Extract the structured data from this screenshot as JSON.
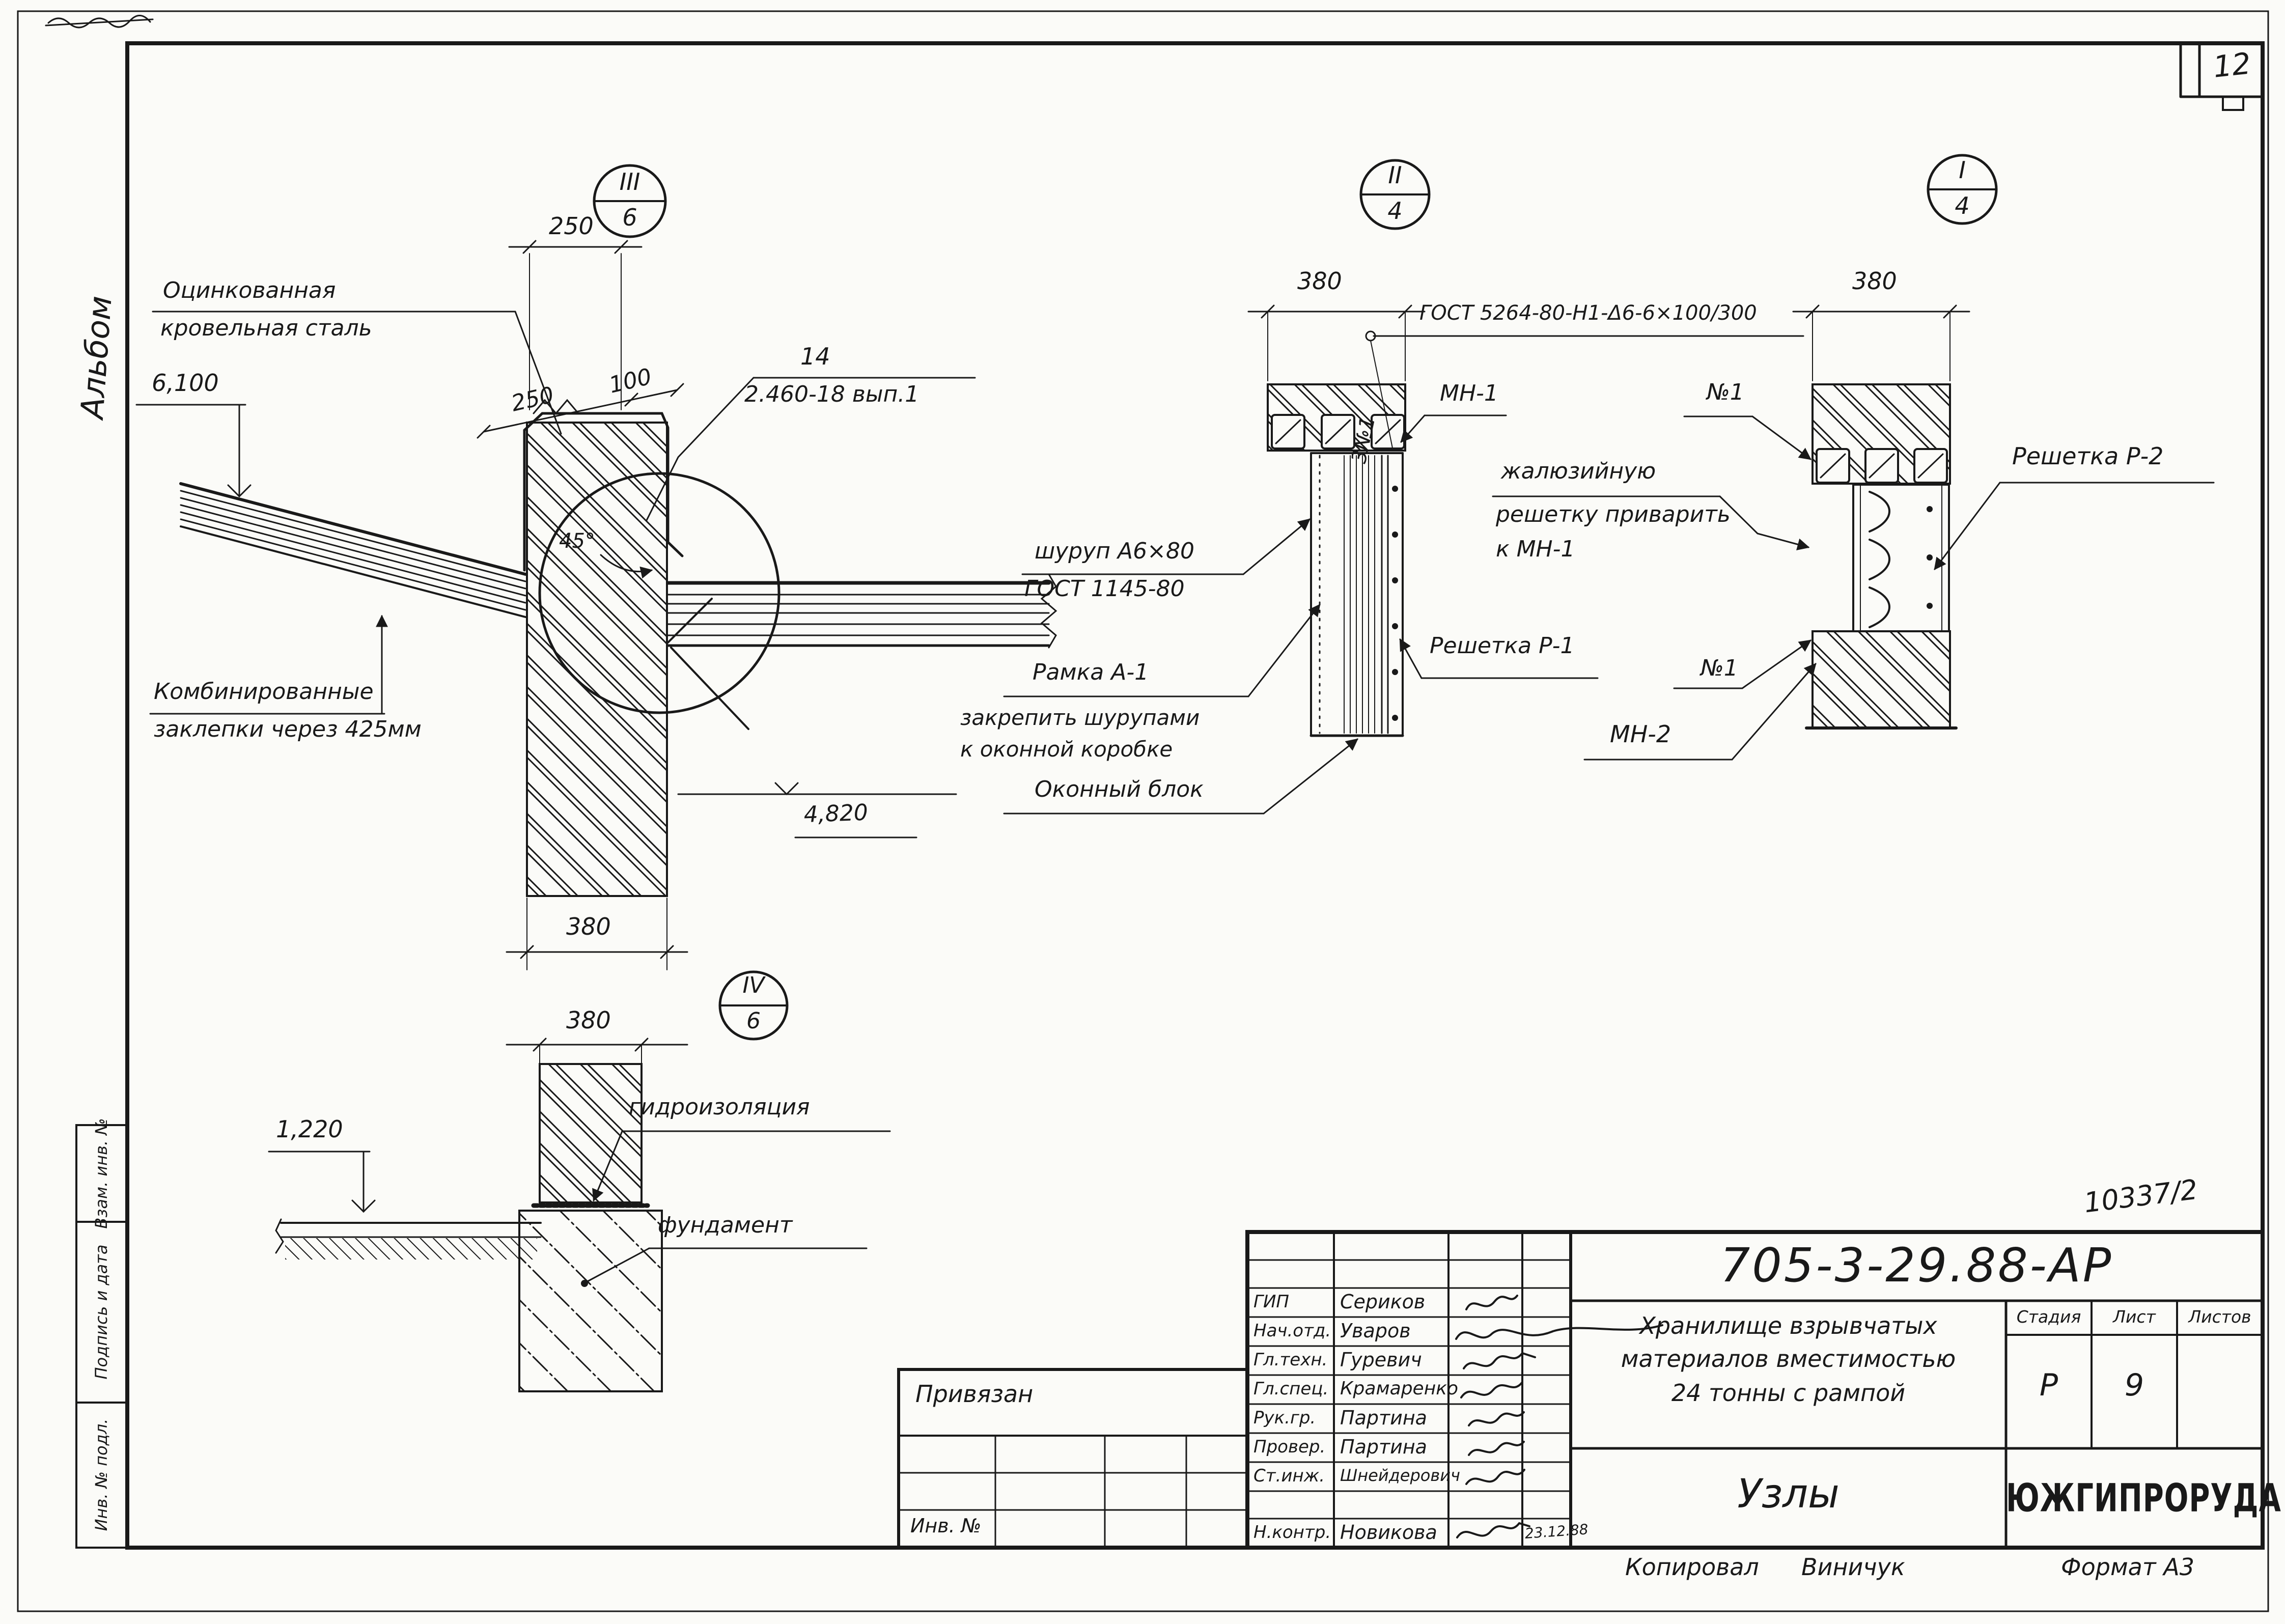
{
  "page": {
    "number": "12",
    "album_label": "Альбом",
    "inv_note": "10337/2",
    "copied_label": "Копировал",
    "copied_name": "Виничук",
    "format_note": "Формат А3",
    "ink_color": "#191919",
    "paper_color": "#fbfbf8"
  },
  "margin_fields": [
    "Взам. инв. №",
    "Подпись и дата",
    "Инв. № подл."
  ],
  "details": {
    "d1": {
      "callout": {
        "num": "III",
        "den": "6"
      },
      "dims": {
        "top": "250",
        "slope_a": "250",
        "slope_b": "100",
        "elev_top": "6,100",
        "elev_mid": "4,820",
        "angle": "45°",
        "width": "380"
      },
      "labels": {
        "steel1": "Оцинкованная",
        "steel2": "кровельная сталь",
        "part_no": "14",
        "part_ref": "2.460-18 вып.1",
        "rivets1": "Комбинированные",
        "rivets2": "заклепки через 425мм"
      }
    },
    "d4": {
      "callout": {
        "num": "IV",
        "den": "6"
      },
      "dims": {
        "width": "380",
        "elev": "1,220"
      },
      "labels": {
        "waterproof": "гидроизоляция",
        "foundation": "фундамент"
      }
    },
    "d2": {
      "callout": {
        "num": "II",
        "den": "4"
      },
      "dims": {
        "width": "380"
      },
      "labels": {
        "gost_weld": "ГОСТ 5264-80-Н1-Δ6-6×100/300",
        "weld_ref": "3№1",
        "mn1": "МН-1",
        "screw1": "шуруп А6×80",
        "screw2": "ГОСТ 1145-80",
        "frame1": "Рамка А-1",
        "frame2": "закрепить шурупами",
        "frame3": "к оконной коробке",
        "window": "Оконный блок",
        "grid1": "Решетка Р-1"
      }
    },
    "d3": {
      "callout": {
        "num": "I",
        "den": "4"
      },
      "dims": {
        "width": "380"
      },
      "labels": {
        "grid2": "Решетка Р-2",
        "jal1": "жалюзийную",
        "jal2": "решетку приварить",
        "jal3": "к МН-1",
        "n1_top": "№1",
        "n1_bot": "№1",
        "mn2": "МН-2"
      }
    }
  },
  "titleblock": {
    "doc_number": "705-3-29.88-АР",
    "rows": [
      {
        "role": "ГИП",
        "name": "Сериков"
      },
      {
        "role": "Нач.отд.",
        "name": "Уваров"
      },
      {
        "role": "Гл.техн.",
        "name": "Гуревич"
      },
      {
        "role": "Гл.спец.",
        "name": "Крамаренко"
      },
      {
        "role": "Рук.гр.",
        "name": "Партина"
      },
      {
        "role": "Провер.",
        "name": "Партина"
      },
      {
        "role": "Ст.инж.",
        "name": "Шнейдерович"
      },
      {
        "role": "Н.контр.",
        "name": "Новикова",
        "date": "23.12.88"
      }
    ],
    "project1": "Хранилище взрывчатых",
    "project2": "материалов вместимостью",
    "project3": "24 тонны с рампой",
    "stage_label": "Стадия",
    "sheet_label": "Лист",
    "sheets_label": "Листов",
    "stage": "Р",
    "sheet": "9",
    "sheets": "",
    "sheet_title": "Узлы",
    "org": "ЮЖГИПРОРУДА",
    "attach_label": "Привязан",
    "inv_label": "Инв. №"
  }
}
